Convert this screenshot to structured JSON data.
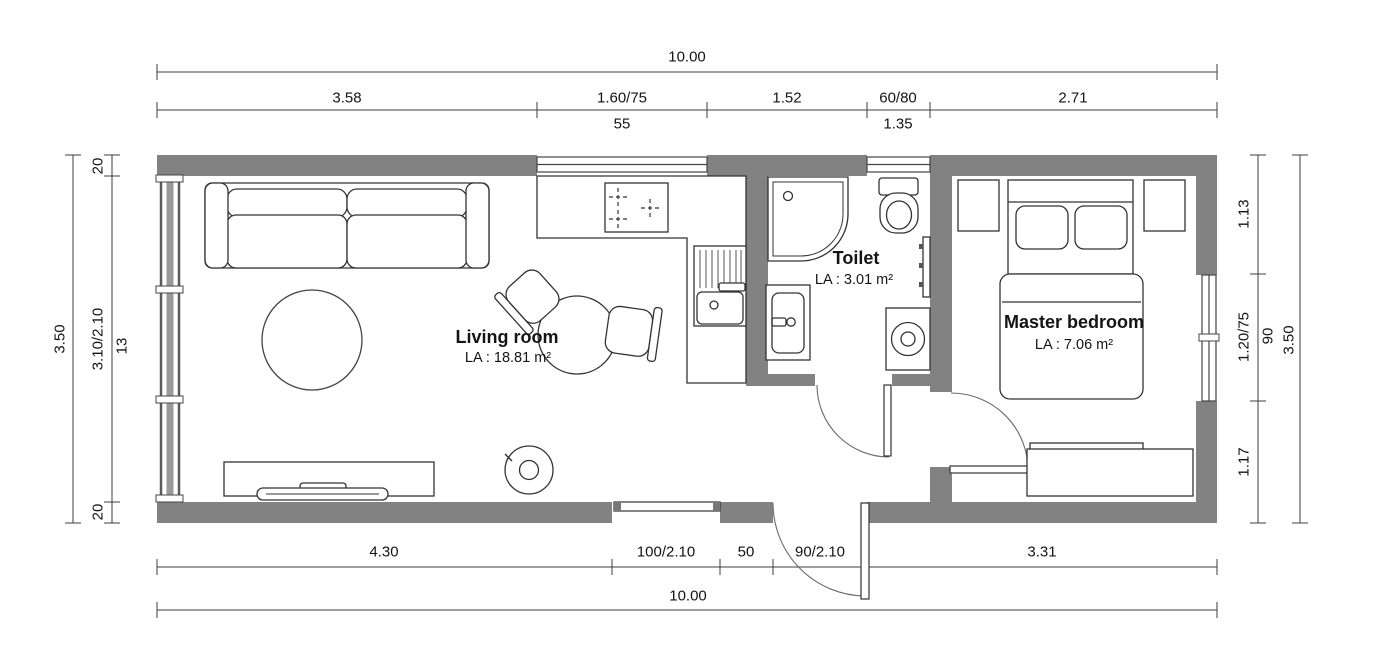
{
  "plan": {
    "rooms": {
      "living": {
        "name": "Living room",
        "area": "LA : 18.81 m²"
      },
      "toilet": {
        "name": "Toilet",
        "area": "LA : 3.01 m²"
      },
      "bedroom": {
        "name": "Master bedroom",
        "area": "LA : 7.06 m²"
      }
    },
    "dimensions": {
      "top": {
        "total": "10.00",
        "segments": [
          "3.58",
          "1.60/75",
          "1.52",
          "60/80",
          "2.71"
        ],
        "sills": [
          "55",
          "1.35"
        ]
      },
      "bottom": {
        "total": "10.00",
        "segments": [
          "4.30",
          "100/2.10",
          "50",
          "90/2.10",
          "3.31"
        ]
      },
      "left": {
        "total": "3.50",
        "segments": [
          "20",
          "3.10/2.10",
          "20"
        ],
        "sill": "13"
      },
      "right": {
        "total": "3.50",
        "segments": [
          "1.13",
          "1.20/75",
          "1.17"
        ],
        "sill": "90"
      }
    }
  }
}
